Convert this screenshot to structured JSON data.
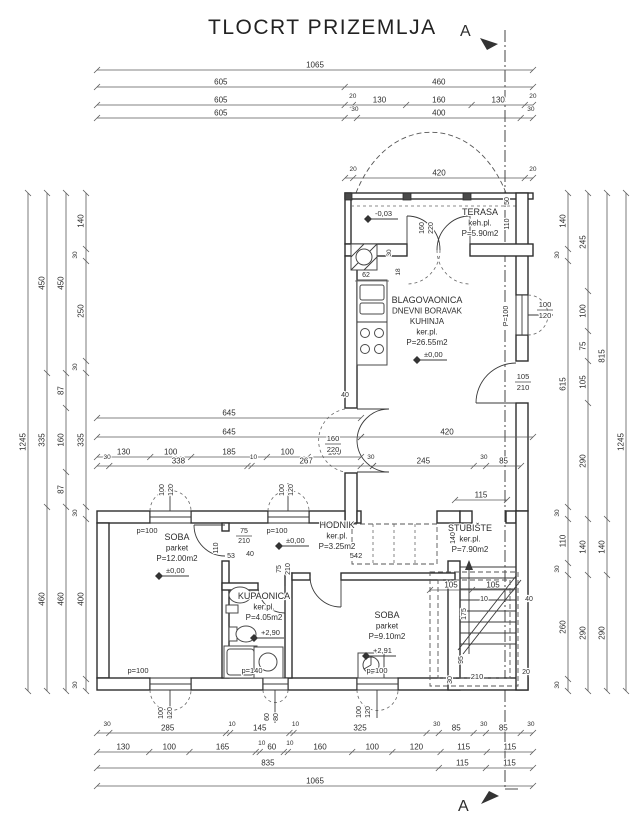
{
  "title": "TLOCRT PRIZEMLJA",
  "section": {
    "label": "A"
  },
  "rooms": [
    {
      "name": "terasa",
      "x": 480,
      "y": 215,
      "lines": [
        "TERASA",
        "keh.pl.",
        "P=5.90m2"
      ]
    },
    {
      "name": "living",
      "x": 427,
      "y": 303,
      "lines": [
        "BLAGOVAONICA",
        "DNEVNI BORAVAK",
        "KUHINJA",
        "ker.pl.",
        "P=26.55m2"
      ]
    },
    {
      "name": "soba-1",
      "x": 177,
      "y": 540,
      "lines": [
        "SOBA",
        "parket",
        "P=12.00m2"
      ]
    },
    {
      "name": "hodnik",
      "x": 337,
      "y": 528,
      "lines": [
        "HODNIK",
        "ker.pl.",
        "P=3.25m2"
      ]
    },
    {
      "name": "kupaonica",
      "x": 264,
      "y": 599,
      "lines": [
        "KUPAONICA",
        "ker.pl.",
        "P=4.05m2"
      ]
    },
    {
      "name": "soba-2",
      "x": 387,
      "y": 618,
      "lines": [
        "SOBA",
        "parket",
        "P=9.10m2"
      ]
    },
    {
      "name": "stubiste",
      "x": 470,
      "y": 531,
      "lines": [
        "STUBIŠTE",
        "ker.pl.",
        "P=7.90m2"
      ]
    }
  ],
  "levels": [
    {
      "t": "-0,03",
      "x": 368,
      "y": 219
    },
    {
      "t": "±0,00",
      "x": 417,
      "y": 360
    },
    {
      "t": "±0,00",
      "x": 279,
      "y": 546
    },
    {
      "t": "±0,00",
      "x": 159,
      "y": 576
    },
    {
      "t": "+2,90",
      "x": 254,
      "y": 638
    },
    {
      "t": "+2,91",
      "x": 366,
      "y": 656
    }
  ],
  "dim_chains": [
    {
      "d": "h",
      "a": 97,
      "b": 533,
      "p": 70,
      "s": [
        1065
      ]
    },
    {
      "d": "h",
      "a": 97,
      "b": 533,
      "p": 87,
      "s": [
        605,
        460
      ]
    },
    {
      "d": "h",
      "a": 97,
      "b": 533,
      "p": 105,
      "s": [
        605,
        20,
        130,
        160,
        130,
        20
      ]
    },
    {
      "d": "h",
      "a": 97,
      "b": 533,
      "p": 118,
      "s": [
        605,
        30,
        400,
        30
      ]
    },
    {
      "d": "h",
      "a": 345,
      "b": 533,
      "p": 178,
      "s": [
        20,
        420,
        20
      ]
    },
    {
      "d": "h",
      "a": 97,
      "b": 361,
      "p": 418,
      "s": [
        645
      ]
    },
    {
      "d": "h",
      "a": 97,
      "b": 361,
      "p": 437,
      "s": [
        645
      ]
    },
    {
      "d": "h",
      "a": 361,
      "b": 533,
      "p": 437,
      "s": [
        420
      ]
    },
    {
      "d": "h",
      "a": 97,
      "b": 361,
      "p": 457,
      "s": [
        130,
        100,
        185,
        100,
        130
      ]
    },
    {
      "d": "h",
      "a": 97,
      "b": 373,
      "p": 466,
      "s": [
        30,
        338,
        10,
        267,
        30
      ]
    },
    {
      "d": "h",
      "a": 373,
      "b": 521,
      "p": 466,
      "s": [
        245,
        30,
        85
      ]
    },
    {
      "d": "h",
      "a": 455,
      "b": 507,
      "p": 500,
      "s": [
        115
      ]
    },
    {
      "d": "h",
      "a": 430,
      "b": 514,
      "p": 590,
      "s": [
        105,
        105
      ]
    },
    {
      "d": "h",
      "a": 97,
      "b": 533,
      "p": 733,
      "s": [
        30,
        285,
        10,
        145,
        10,
        325,
        30,
        85,
        30,
        85,
        30
      ]
    },
    {
      "d": "h",
      "a": 97,
      "b": 533,
      "p": 752,
      "s": [
        130,
        100,
        165,
        10,
        60,
        10,
        160,
        100,
        120,
        115,
        115
      ]
    },
    {
      "d": "h",
      "a": 97,
      "b": 533,
      "p": 768,
      "s": [
        835,
        115,
        115
      ]
    },
    {
      "d": "h",
      "a": 97,
      "b": 533,
      "p": 786,
      "s": [
        1065
      ]
    },
    {
      "d": "v",
      "a": 193,
      "b": 691,
      "p": 28,
      "s": [
        1245
      ]
    },
    {
      "d": "v",
      "a": 193,
      "b": 691,
      "p": 47,
      "s": [
        450,
        335,
        460
      ]
    },
    {
      "d": "v",
      "a": 193,
      "b": 691,
      "p": 66,
      "s": [
        450,
        87,
        160,
        87,
        460
      ]
    },
    {
      "d": "v",
      "a": 193,
      "b": 691,
      "p": 86,
      "s": [
        140,
        30,
        250,
        30,
        335,
        30,
        400,
        30
      ]
    },
    {
      "d": "v",
      "a": 193,
      "b": 691,
      "p": 568,
      "s": [
        140,
        30,
        615,
        30,
        110,
        30,
        260,
        30
      ]
    },
    {
      "d": "v",
      "a": 193,
      "b": 691,
      "p": 588,
      "s": [
        245,
        100,
        75,
        105,
        290,
        140,
        290
      ]
    },
    {
      "d": "v",
      "a": 193,
      "b": 691,
      "p": 607,
      "s": [
        815,
        140,
        290
      ]
    },
    {
      "d": "v",
      "a": 193,
      "b": 691,
      "p": 626,
      "s": [
        1245
      ]
    }
  ],
  "labels": [
    {
      "t": "160",
      "x": 424,
      "y": 228,
      "r": -90,
      "fs": 7
    },
    {
      "t": "220",
      "x": 433,
      "y": 228,
      "r": -90,
      "fs": 7
    },
    {
      "t": "50",
      "x": 509,
      "y": 201,
      "r": -90,
      "fs": 7
    },
    {
      "t": "110",
      "x": 509,
      "y": 224,
      "r": -90,
      "fs": 7
    },
    {
      "t": "100",
      "x": 545,
      "y": 307,
      "fs": 7.5
    },
    {
      "t": "120",
      "x": 545,
      "y": 318,
      "fs": 7.5
    },
    {
      "t": "P=100",
      "x": 508,
      "y": 316,
      "r": -90,
      "fs": 7
    },
    {
      "t": "105",
      "x": 523,
      "y": 379,
      "fs": 7.5
    },
    {
      "t": "210",
      "x": 523,
      "y": 390,
      "fs": 7.5
    },
    {
      "t": "40",
      "x": 345,
      "y": 397,
      "fs": 7
    },
    {
      "t": "30",
      "x": 391,
      "y": 253,
      "r": -90,
      "fs": 6.5
    },
    {
      "t": "18",
      "x": 400,
      "y": 272,
      "r": -90,
      "fs": 6.5
    },
    {
      "t": "62",
      "x": 366,
      "y": 277,
      "fs": 7
    },
    {
      "t": "160",
      "x": 333,
      "y": 441,
      "fs": 7.5
    },
    {
      "t": "220",
      "x": 333,
      "y": 452,
      "fs": 7.5
    },
    {
      "t": "100",
      "x": 164,
      "y": 490,
      "r": -90,
      "fs": 7
    },
    {
      "t": "120",
      "x": 173,
      "y": 490,
      "r": -90,
      "fs": 7
    },
    {
      "t": "100",
      "x": 284,
      "y": 490,
      "r": -90,
      "fs": 7
    },
    {
      "t": "120",
      "x": 293,
      "y": 490,
      "r": -90,
      "fs": 7
    },
    {
      "t": "p=100",
      "x": 147,
      "y": 533,
      "fs": 7.5
    },
    {
      "t": "p=100",
      "x": 277,
      "y": 533,
      "fs": 7.5
    },
    {
      "t": "75",
      "x": 244,
      "y": 533,
      "fs": 7
    },
    {
      "t": "210",
      "x": 244,
      "y": 543,
      "fs": 7
    },
    {
      "t": "110",
      "x": 218,
      "y": 548,
      "r": -90,
      "fs": 7
    },
    {
      "t": "53",
      "x": 231,
      "y": 558,
      "fs": 7
    },
    {
      "t": "40",
      "x": 250,
      "y": 556,
      "fs": 7
    },
    {
      "t": "542",
      "x": 356,
      "y": 558,
      "fs": 7.5
    },
    {
      "t": "75",
      "x": 281,
      "y": 569,
      "r": -90,
      "fs": 7
    },
    {
      "t": "210",
      "x": 290,
      "y": 569,
      "r": -90,
      "fs": 7
    },
    {
      "t": "140",
      "x": 455,
      "y": 538,
      "r": -90,
      "fs": 7
    },
    {
      "t": "10",
      "x": 484,
      "y": 601,
      "fs": 7
    },
    {
      "t": "40",
      "x": 529,
      "y": 601,
      "fs": 7
    },
    {
      "t": "175",
      "x": 466,
      "y": 614,
      "r": -90,
      "fs": 7
    },
    {
      "t": "95",
      "x": 463,
      "y": 660,
      "r": -90,
      "fs": 7
    },
    {
      "t": "30",
      "x": 452,
      "y": 680,
      "r": -90,
      "fs": 7
    },
    {
      "t": "210",
      "x": 477,
      "y": 679,
      "fs": 7.5
    },
    {
      "t": "20",
      "x": 526,
      "y": 674,
      "fs": 7
    },
    {
      "t": "100",
      "x": 163,
      "y": 713,
      "r": -90,
      "fs": 7
    },
    {
      "t": "120",
      "x": 172,
      "y": 713,
      "r": -90,
      "fs": 7
    },
    {
      "t": "60",
      "x": 269,
      "y": 717,
      "r": -90,
      "fs": 7
    },
    {
      "t": "80",
      "x": 278,
      "y": 717,
      "r": -90,
      "fs": 7
    },
    {
      "t": "100",
      "x": 361,
      "y": 712,
      "r": -90,
      "fs": 7
    },
    {
      "t": "120",
      "x": 370,
      "y": 712,
      "r": -90,
      "fs": 7
    },
    {
      "t": "p=100",
      "x": 138,
      "y": 673,
      "fs": 7.5
    },
    {
      "t": "p=140",
      "x": 252,
      "y": 673,
      "fs": 7.5
    },
    {
      "t": "p=100",
      "x": 377,
      "y": 673,
      "fs": 7.5
    }
  ],
  "colors": {
    "line": "#2e2e2e",
    "dim": "#5a5a5a",
    "background": "#ffffff"
  }
}
